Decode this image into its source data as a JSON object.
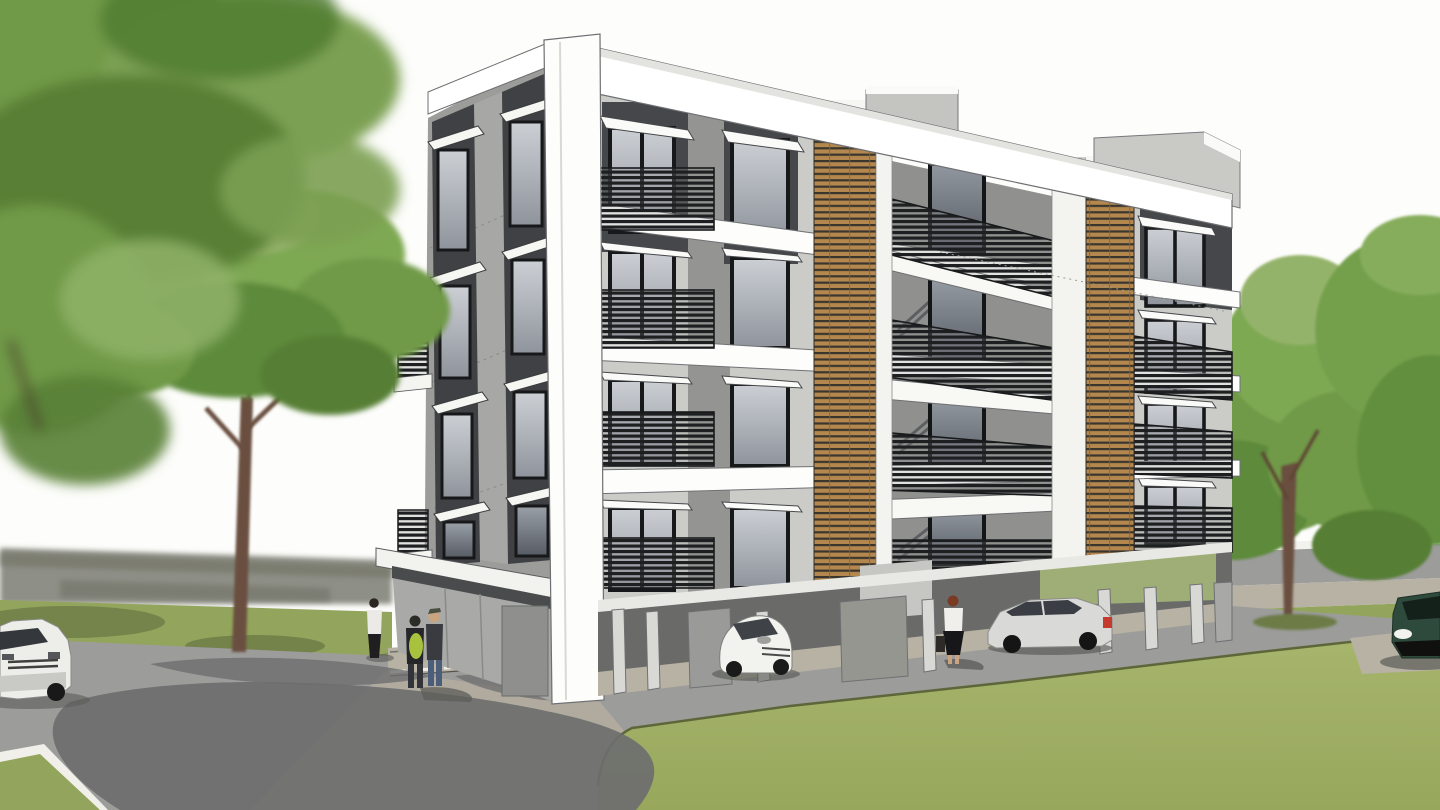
{
  "scene": {
    "title": "Apartment Building – Exterior 3D Rendering",
    "type": "3d-architectural-rendering",
    "description": "SketchUp-style exterior perspective rendering of a modern four-storey apartment block on pilotis. Shaded left facade with charcoal window strips and awnings; sunlit right facade with white floor slabs, dark slatted balcony railings and two vertical timber louvre screens. Open ground-floor parking holds a white city car and a silver sedan. Three pedestrians stand at the left corner, a woman with a bag walks along the sidewalk. Large blurred green trees frame the view left and right; grey road with tree shadows and a bright green lawn fill the foreground; partial white sedan at the left edge and dark green SUV at the right edge.",
    "objects": [
      "apartment-building",
      "left-shaded-facade",
      "right-sunlit-facade",
      "timber-louvre-screen-1",
      "timber-louvre-screen-2",
      "balcony-railings",
      "floor-slabs",
      "roof-parapet",
      "rooftop-stair-bulkhead",
      "pilotis-parking",
      "white-city-car",
      "silver-sedan",
      "white-sedan-left-edge",
      "green-suv-right-edge",
      "pedestrian-pair",
      "woman-standing-left",
      "woman-with-bag",
      "foreground-blurred-tree",
      "mid-left-tree",
      "right-trees",
      "lawn",
      "road",
      "sidewalk",
      "tree-shadows"
    ]
  },
  "palette": {
    "sky": "#fdfdfb",
    "canopy_light": "#94b36a",
    "canopy_mid": "#6f9a47",
    "canopy_dark": "#4e7a30",
    "trunk": "#6b4f3f",
    "facade_white": "#ffffff",
    "facade_light": "#cbcbc8",
    "facade_mid": "#9c9d9a",
    "facade_recessed": "#90918f",
    "charcoal_panel": "#404144",
    "glass_light": "#b9bdc4",
    "glass_dark": "#3c4046",
    "railing": "#1e1f21",
    "wood_slat": "#b3874e",
    "wood_gap": "#3a362e",
    "road": "#9c9c9b",
    "road_shadow": "#6e6e6f",
    "sidewalk": "#b7b2a4",
    "apron": "#b0ab9e",
    "grass": "#a2b168",
    "grass_far": "#93a55c",
    "grass_shadow": "#6d7c46",
    "blur_band": "#8e8f86",
    "interior_shadow": "#6a6b69",
    "car_white": "#f2f2ef",
    "car_silver": "#d9dad8",
    "car_green": "#2e4a3c",
    "taillight": "#c43b2e",
    "backpack_green": "#a8c23d",
    "denim": "#4a5e79",
    "hair_red": "#7a3b24",
    "skin": "#caa37f"
  }
}
